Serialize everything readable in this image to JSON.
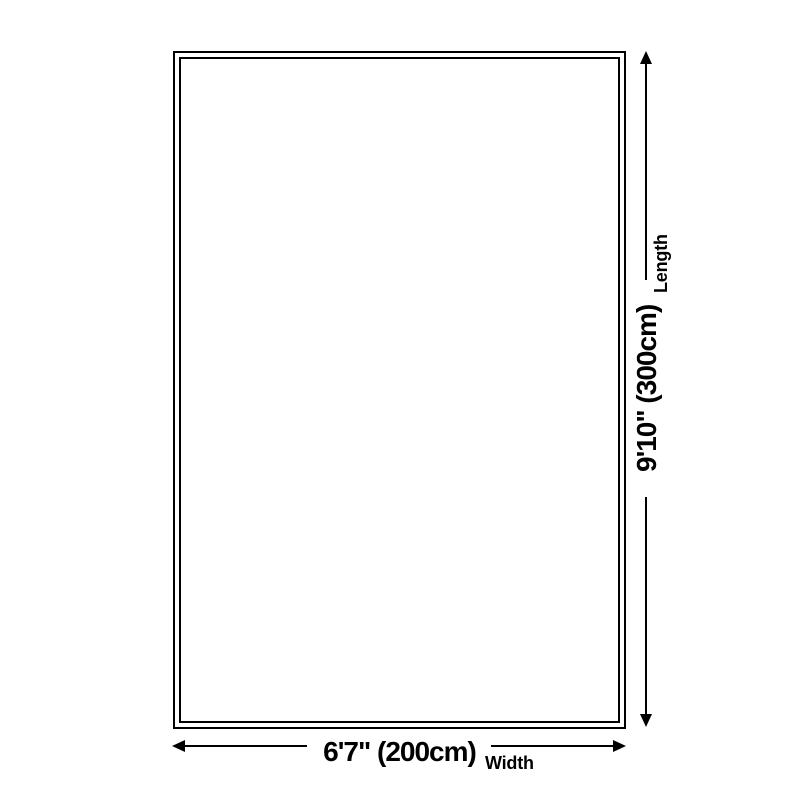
{
  "diagram": {
    "kind": "rug-size-dimension-diagram",
    "background_color": "#ffffff",
    "line_color": "#000000",
    "text_color": "#000000",
    "rug": {
      "shape": "rectangle",
      "border_style": "double"
    },
    "width": {
      "value": "6'7\" (200cm)",
      "label": "Width"
    },
    "length": {
      "value": "9'10\" (300cm)",
      "label": "Length"
    }
  }
}
